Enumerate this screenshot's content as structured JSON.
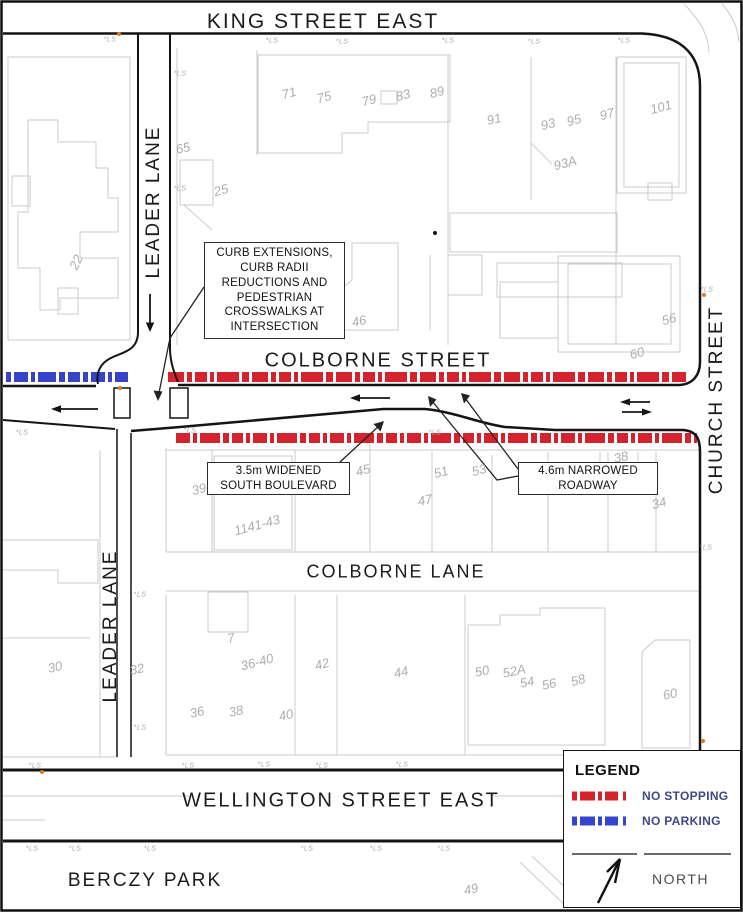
{
  "map": {
    "streets": {
      "king": "KING STREET EAST",
      "leader_upper": "LEADER LANE",
      "leader_lower": "LEADER LANE",
      "church": "CHURCH STREET",
      "colborne": "COLBORNE STREET",
      "colborne_lane": "COLBORNE LANE",
      "wellington": "WELLINGTON STREET EAST",
      "berczy": "BERCZY PARK"
    },
    "callouts": {
      "intersection": "CURB EXTENSIONS,\nCURB RADII\nREDUCTIONS AND\nPEDESTRIAN\nCROSSWALKS AT\nINTERSECTION",
      "boulevard": "3.5m WIDENED\nSOUTH BOULEVARD",
      "roadway": "4.6m NARROWED\nROADWAY"
    },
    "building_numbers": [
      {
        "label": "65",
        "x": 183,
        "y": 148,
        "r": -12
      },
      {
        "label": "71",
        "x": 289,
        "y": 93,
        "r": -15
      },
      {
        "label": "75",
        "x": 324,
        "y": 97,
        "r": -15
      },
      {
        "label": "79",
        "x": 369,
        "y": 100,
        "r": -15
      },
      {
        "label": "83",
        "x": 403,
        "y": 95,
        "r": -15
      },
      {
        "label": "89",
        "x": 437,
        "y": 92,
        "r": -15
      },
      {
        "label": "91",
        "x": 494,
        "y": 119,
        "r": -12
      },
      {
        "label": "93",
        "x": 548,
        "y": 124,
        "r": -15
      },
      {
        "label": "95",
        "x": 574,
        "y": 120,
        "r": -15
      },
      {
        "label": "97",
        "x": 607,
        "y": 114,
        "r": -15
      },
      {
        "label": "101",
        "x": 661,
        "y": 107,
        "r": -15
      },
      {
        "label": "93A",
        "x": 565,
        "y": 163,
        "r": -15
      },
      {
        "label": "25",
        "x": 221,
        "y": 190,
        "r": -15
      },
      {
        "label": "22",
        "x": 76,
        "y": 262,
        "r": -65
      },
      {
        "label": "46",
        "x": 359,
        "y": 321,
        "r": -12
      },
      {
        "label": "56",
        "x": 669,
        "y": 319,
        "r": -15
      },
      {
        "label": "60",
        "x": 637,
        "y": 353,
        "r": -15
      },
      {
        "label": "39",
        "x": 199,
        "y": 489,
        "r": -15
      },
      {
        "label": "1141-43",
        "x": 257,
        "y": 525,
        "r": -15
      },
      {
        "label": "45",
        "x": 363,
        "y": 470,
        "r": -15
      },
      {
        "label": "47",
        "x": 425,
        "y": 500,
        "r": -12
      },
      {
        "label": "51",
        "x": 441,
        "y": 472,
        "r": -15
      },
      {
        "label": "53",
        "x": 479,
        "y": 470,
        "r": -15
      },
      {
        "label": "38",
        "x": 621,
        "y": 457,
        "r": -12
      },
      {
        "label": "36",
        "x": 651,
        "y": 477,
        "r": -12
      },
      {
        "label": "34",
        "x": 659,
        "y": 503,
        "r": -15
      },
      {
        "label": "30",
        "x": 55,
        "y": 667,
        "r": -12
      },
      {
        "label": "32",
        "x": 137,
        "y": 669,
        "r": -12
      },
      {
        "label": "7",
        "x": 231,
        "y": 638,
        "r": -12
      },
      {
        "label": "36-40",
        "x": 257,
        "y": 662,
        "r": -15
      },
      {
        "label": "42",
        "x": 322,
        "y": 664,
        "r": -15
      },
      {
        "label": "36",
        "x": 197,
        "y": 712,
        "r": -12
      },
      {
        "label": "38",
        "x": 236,
        "y": 711,
        "r": -12
      },
      {
        "label": "40",
        "x": 286,
        "y": 715,
        "r": -12
      },
      {
        "label": "44",
        "x": 401,
        "y": 672,
        "r": -12
      },
      {
        "label": "50",
        "x": 482,
        "y": 671,
        "r": -12
      },
      {
        "label": "52A",
        "x": 514,
        "y": 671,
        "r": -12
      },
      {
        "label": "54",
        "x": 527,
        "y": 682,
        "r": -12
      },
      {
        "label": "56",
        "x": 549,
        "y": 684,
        "r": -12
      },
      {
        "label": "58",
        "x": 578,
        "y": 680,
        "r": -15
      },
      {
        "label": "60",
        "x": 670,
        "y": 694,
        "r": -12
      },
      {
        "label": "49",
        "x": 471,
        "y": 889,
        "r": -12
      }
    ],
    "ls_markers": [
      {
        "label": "*LS",
        "x": 110,
        "y": 40
      },
      {
        "label": "*LS",
        "x": 272,
        "y": 41
      },
      {
        "label": "*LS",
        "x": 342,
        "y": 42
      },
      {
        "label": "*LS",
        "x": 448,
        "y": 41
      },
      {
        "label": "*LS",
        "x": 534,
        "y": 42
      },
      {
        "label": "*LS",
        "x": 624,
        "y": 41
      },
      {
        "label": "*LS",
        "x": 180,
        "y": 74
      },
      {
        "label": "*LS",
        "x": 180,
        "y": 189
      },
      {
        "label": "*LS",
        "x": 22,
        "y": 433
      },
      {
        "label": "*LS",
        "x": 190,
        "y": 431
      },
      {
        "label": "*LS",
        "x": 435,
        "y": 433
      },
      {
        "label": "*LS",
        "x": 140,
        "y": 595
      },
      {
        "label": "*LS",
        "x": 140,
        "y": 728
      },
      {
        "label": "*LS",
        "x": 35,
        "y": 766
      },
      {
        "label": "*LS",
        "x": 188,
        "y": 766
      },
      {
        "label": "*LS",
        "x": 264,
        "y": 765
      },
      {
        "label": "*LS",
        "x": 322,
        "y": 766
      },
      {
        "label": "*LS",
        "x": 402,
        "y": 765
      },
      {
        "label": "*LS",
        "x": 32,
        "y": 849
      },
      {
        "label": "*LS",
        "x": 75,
        "y": 849
      },
      {
        "label": "*LS",
        "x": 150,
        "y": 849
      },
      {
        "label": "*LS",
        "x": 307,
        "y": 849
      },
      {
        "label": "*LS",
        "x": 376,
        "y": 849
      },
      {
        "label": "*LS",
        "x": 444,
        "y": 849
      },
      {
        "label": "*LS",
        "x": 707,
        "y": 290
      },
      {
        "label": "*LS",
        "x": 706,
        "y": 548
      }
    ]
  },
  "legend": {
    "title": "LEGEND",
    "items": [
      {
        "label": "NO STOPPING",
        "color": "#d5232e"
      },
      {
        "label": "NO PARKING",
        "color": "#3644cb"
      }
    ],
    "north_label": "NORTH"
  },
  "colors": {
    "no_stopping": "#d5232e",
    "no_parking": "#3644cb",
    "outline": "#cbcbcb",
    "number_gray": "#adadad"
  }
}
